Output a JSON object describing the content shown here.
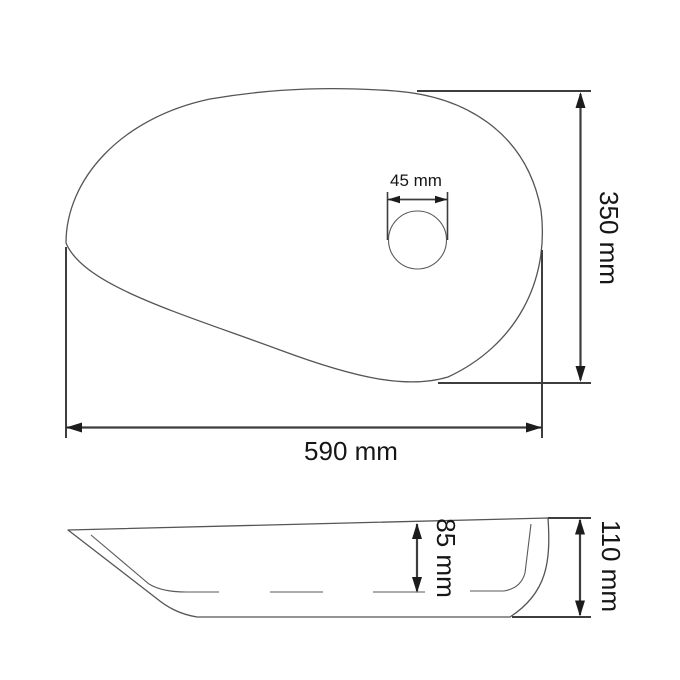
{
  "drawing": {
    "background_color": "#ffffff",
    "dimension_line_color": "#3d3d3d",
    "outline_color": "#555555",
    "text_color": "#161616",
    "top_view": {
      "width_label": "590 mm",
      "width_mm": 590,
      "height_label": "350 mm",
      "height_mm": 350,
      "drain_diameter_label": "45 mm",
      "drain_diameter_mm": 45
    },
    "side_view": {
      "inner_depth_label": "85 mm",
      "inner_depth_mm": 85,
      "total_height_label": "110 mm",
      "total_height_mm": 110
    }
  }
}
